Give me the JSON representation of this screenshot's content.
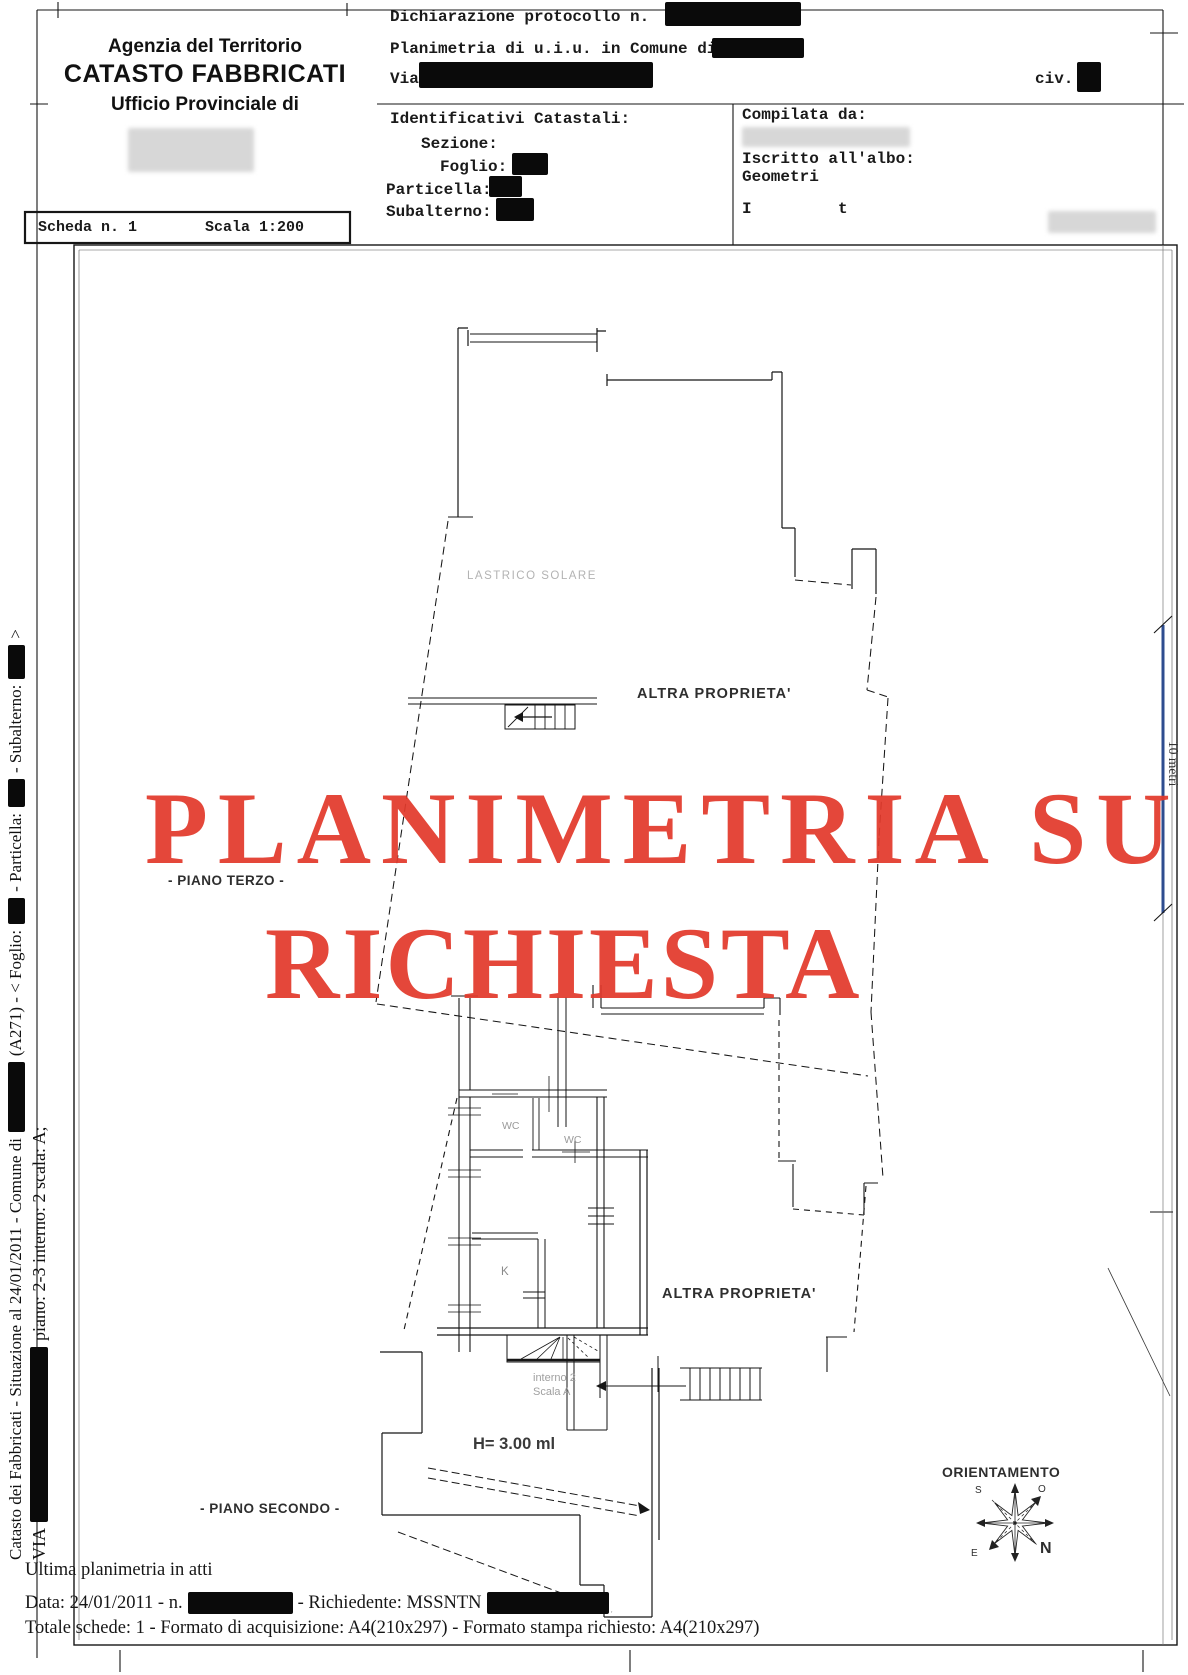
{
  "header": {
    "agency": {
      "line1": "Agenzia del Territorio",
      "line2": "CATASTO FABBRICATI",
      "line3": "Ufficio Provinciale di"
    },
    "dichiarazione_label": "Dichiarazione protocollo n.",
    "planimetria_label": "Planimetria di u.i.u. in Comune di",
    "via_label": "Via",
    "civ_label": "civ.",
    "identificativi_label": "Identificativi Catastali:",
    "sezione_label": "Sezione:",
    "foglio_label": "Foglio:",
    "particella_label": "Particella:",
    "subalterno_label": "Subalterno:",
    "compilata_label": "Compilata da:",
    "iscritto_label": "Iscritto all'albo:",
    "albo_value": "Geometri",
    "partial_initial_1": "I",
    "partial_initial_2": "t"
  },
  "scheda": {
    "number_label": "Scheda n. 1",
    "scale_label": "Scala 1:200"
  },
  "stamp": {
    "line1": "PLANIMETRIA SU",
    "line2": "RICHIESTA",
    "color": "#e23a2c"
  },
  "plan": {
    "lastrico_label": "LASTRICO SOLARE",
    "altra_top_label": "ALTRA PROPRIETA'",
    "piano_terzo_label": "- PIANO TERZO -",
    "altra_bottom_label": "ALTRA PROPRIETA'",
    "wc1_label": "WC",
    "wc2_label": "WC",
    "kitchen_label": "K",
    "interno_label": "interno 2",
    "scala_label": "Scala A",
    "height_label": "H= 3.00 ml",
    "piano_secondo_label": "- PIANO SECONDO -"
  },
  "compass": {
    "title": "ORIENTAMENTO",
    "n": "N",
    "s": "S",
    "e": "E",
    "o": "O"
  },
  "scalebar": {
    "label": "10 metri",
    "color": "#2e4d8f"
  },
  "side": {
    "line1_part1": "Catasto dei Fabbricati - Situazione al 24/01/2011 - Comune di",
    "line1_part2": "(A271) - < Foglio:",
    "line1_part3": "- Particella:",
    "line1_part4": "- Subalterno:",
    "line1_part5": ">",
    "line2_part1": "VIA",
    "line2_part2": "piano: 2-3 interno: 2 scala: A;"
  },
  "footer": {
    "ultima": "Ultima planimetria in atti",
    "data_part1": "Data: 24/01/2011 - n.",
    "data_part2": "- Richiedente: MSSNTN",
    "totale": "Totale schede: 1 - Formato di acquisizione: A4(210x297)  - Formato stampa richiesto: A4(210x297)"
  }
}
